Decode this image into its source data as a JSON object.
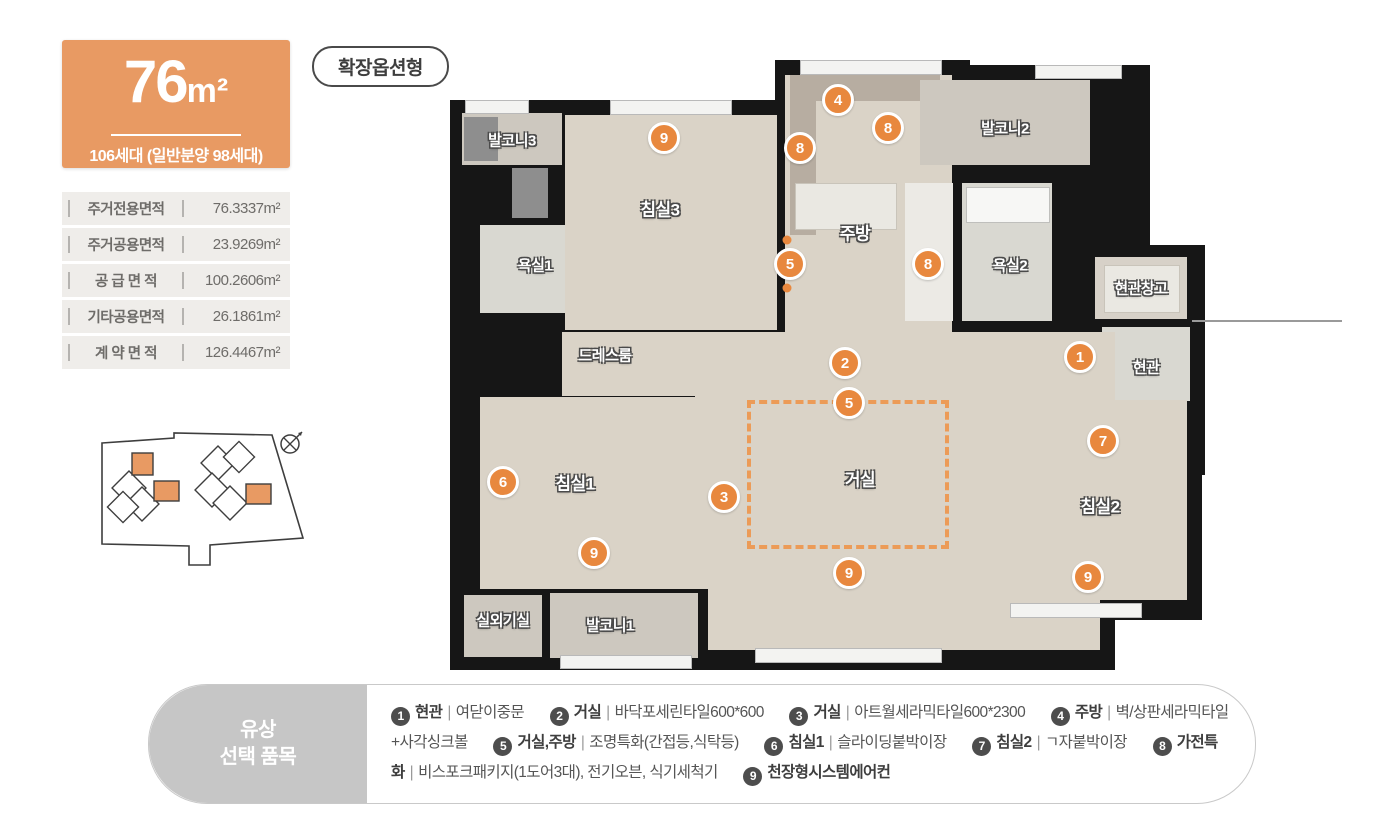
{
  "colors": {
    "badge_orange": "#E89A63",
    "marker_orange": "#E8883E",
    "dash_orange": "#EC9B57",
    "legend_gray": "#C6C6C6"
  },
  "unit_badge": {
    "size_number": "76",
    "size_unit": "m²",
    "households": "106세대 (일반분양 98세대)"
  },
  "option_badge": "확장옵션형",
  "area_table": {
    "rows": [
      {
        "label": "주거전용면적",
        "value": "76.3337m²"
      },
      {
        "label": "주거공용면적",
        "value": "23.9269m²"
      },
      {
        "label": "공 급 면 적",
        "value": "100.2606m²"
      },
      {
        "label": "기타공용면적",
        "value": "26.1861m²"
      },
      {
        "label": "계 약 면 적",
        "value": "126.4467m²"
      }
    ]
  },
  "floor_plan": {
    "rooms": [
      {
        "name": "발코니3",
        "x": 62,
        "y": 85
      },
      {
        "name": "침실3",
        "x": 210,
        "y": 153,
        "size": 17
      },
      {
        "name": "주방",
        "x": 405,
        "y": 177,
        "size": 17
      },
      {
        "name": "발코니2",
        "x": 555,
        "y": 73
      },
      {
        "name": "욕실1",
        "x": 85,
        "y": 210
      },
      {
        "name": "욕실2",
        "x": 560,
        "y": 210
      },
      {
        "name": "현관창고",
        "x": 691,
        "y": 233
      },
      {
        "name": "현관",
        "x": 696,
        "y": 312
      },
      {
        "name": "드레스룸",
        "x": 155,
        "y": 300
      },
      {
        "name": "침실1",
        "x": 125,
        "y": 427,
        "size": 17
      },
      {
        "name": "거실",
        "x": 410,
        "y": 423,
        "size": 17
      },
      {
        "name": "침실2",
        "x": 650,
        "y": 450,
        "size": 17
      },
      {
        "name": "실외기실",
        "x": 53,
        "y": 565
      },
      {
        "name": "발코니1",
        "x": 160,
        "y": 570
      }
    ],
    "markers": [
      {
        "n": "9",
        "x": 214,
        "y": 83
      },
      {
        "n": "4",
        "x": 388,
        "y": 45
      },
      {
        "n": "8",
        "x": 350,
        "y": 93
      },
      {
        "n": "8",
        "x": 438,
        "y": 73
      },
      {
        "n": "5",
        "x": 340,
        "y": 209
      },
      {
        "n": "8",
        "x": 478,
        "y": 209
      },
      {
        "n": "2",
        "x": 395,
        "y": 308
      },
      {
        "n": "1",
        "x": 630,
        "y": 302
      },
      {
        "n": "5",
        "x": 399,
        "y": 348
      },
      {
        "n": "7",
        "x": 653,
        "y": 386
      },
      {
        "n": "6",
        "x": 53,
        "y": 427
      },
      {
        "n": "3",
        "x": 274,
        "y": 442
      },
      {
        "n": "9",
        "x": 144,
        "y": 498
      },
      {
        "n": "9",
        "x": 399,
        "y": 518
      },
      {
        "n": "9",
        "x": 638,
        "y": 522
      }
    ],
    "dots": [
      {
        "x": 337,
        "y": 185
      },
      {
        "x": 337,
        "y": 233
      }
    ]
  },
  "legend": {
    "title_line1": "유상",
    "title_line2": "선택 품목",
    "items": [
      {
        "num": "1",
        "label": "현관",
        "desc": "여닫이중문"
      },
      {
        "num": "2",
        "label": "거실",
        "desc": "바닥포세린타일600*600"
      },
      {
        "num": "3",
        "label": "거실",
        "desc": "아트월세라믹타일600*2300"
      },
      {
        "num": "4",
        "label": "주방",
        "desc": "벽/상판세라믹타일+사각싱크볼"
      },
      {
        "num": "5",
        "label": "거실,주방",
        "desc": "조명특화(간접등,식탁등)"
      },
      {
        "num": "6",
        "label": "침실1",
        "desc": "슬라이딩붙박이장"
      },
      {
        "num": "7",
        "label": "침실2",
        "desc": "ㄱ자붙박이장"
      },
      {
        "num": "8",
        "label": "가전특화",
        "desc": "비스포크패키지(1도어3대), 전기오븐, 식기세척기"
      },
      {
        "num": "9",
        "label": "천장형시스템에어컨",
        "desc": ""
      }
    ]
  }
}
